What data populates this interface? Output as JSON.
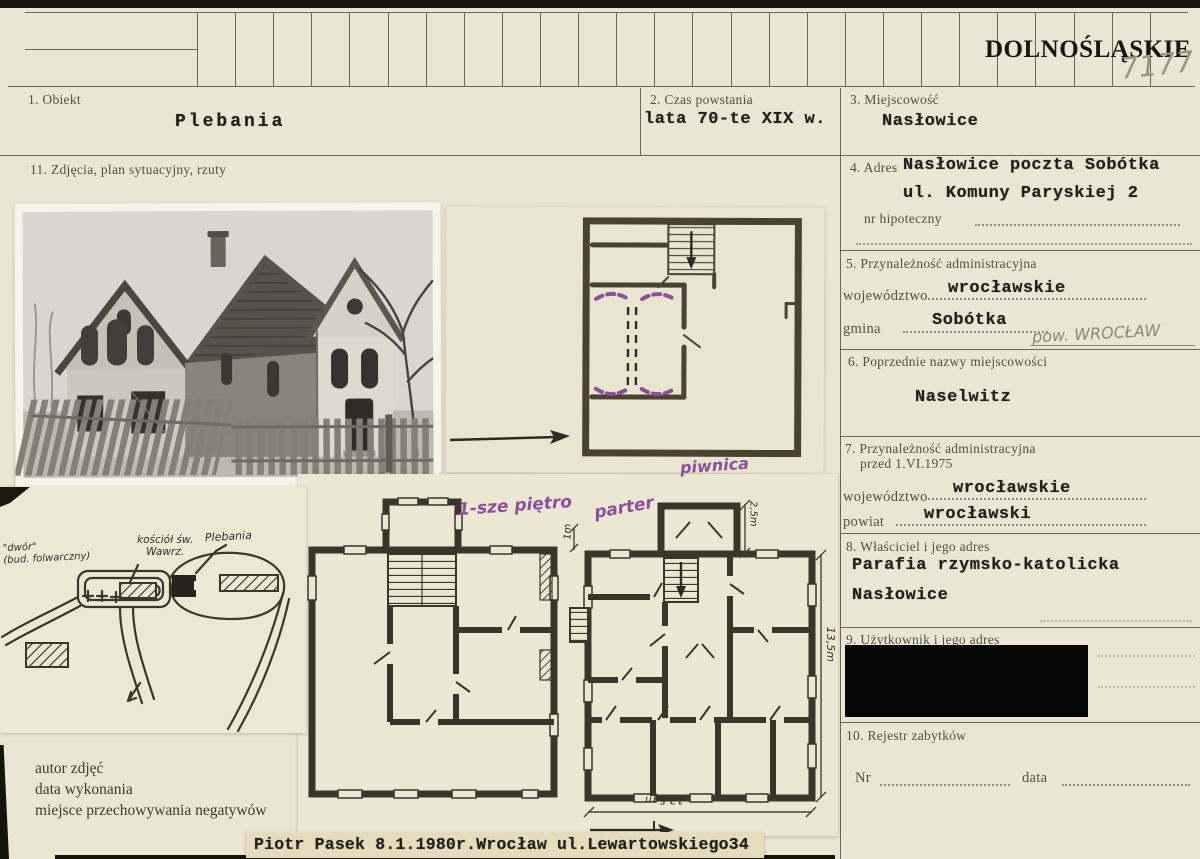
{
  "header": {
    "region": "DOLNOŚLĄSKIE",
    "handwritten_number": "7177"
  },
  "fields": {
    "f1": {
      "label": "1. Obiekt",
      "value": "Plebania"
    },
    "f2": {
      "label": "2. Czas powstania",
      "value": "lata 70-te XIX w."
    },
    "f3": {
      "label": "3. Miejscowość",
      "value": "Nasłowice"
    },
    "f4": {
      "label": "4. Adres",
      "value_line1": "Nasłowice poczta Sobótka",
      "value_line2": "ul. Komuny Paryskiej 2",
      "hypothec_label": "nr hipoteczny"
    },
    "f5": {
      "label": "5. Przynależność administracyjna",
      "wojewodztwo_label": "województwo",
      "wojewodztwo_value": "wrocławskie",
      "gmina_label": "gmina",
      "gmina_value": "Sobótka",
      "pencil_note": "pow. WROCŁAW"
    },
    "f6": {
      "label": "6. Poprzednie nazwy miejscowości",
      "value": "Naselwitz"
    },
    "f7": {
      "label_line1": "7. Przynależność administracyjna",
      "label_line2": "przed 1.VI.1975",
      "wojewodztwo_label": "województwo",
      "wojewodztwo_value": "wrocławskie",
      "powiat_label": "powiat",
      "powiat_value": "wrocławski"
    },
    "f8": {
      "label": "8. Właściciel i jego adres",
      "value_line1": "Parafia rzymsko-katolicka",
      "value_line2": "Nasłowice"
    },
    "f9": {
      "label": "9. Użytkownik i jego adres"
    },
    "f10": {
      "label": "10. Rejestr zabytków",
      "nr_label": "Nr",
      "data_label": "data"
    },
    "f11": {
      "label": "11. Zdjęcia, plan sytuacyjny, rzuty"
    }
  },
  "photo_credit_labels": {
    "line1": "autor zdjęć",
    "line2": "data wykonania",
    "line3": "miejsce przechowywania negatywów"
  },
  "bottom_note": "Piotr Pasek 8.1.1980r.Wrocław ul.Lewartowskiego34",
  "plan_labels": {
    "basement": "piwnica",
    "first_floor": "1-sze piętro",
    "ground_floor": "parter",
    "dim_1m": "1m",
    "dim_2_5m": "2,5m",
    "dim_13_5m_right": "13,5m",
    "dim_13_5m_bottom": "13,5 m"
  },
  "site_plan_labels": {
    "farm_building_line1": "\"dwór\"",
    "farm_building_line2": "(bud. folwarczny)",
    "church_line1": "kościół św.",
    "church_line2": "Wawrz.",
    "rectory": "Plebania"
  },
  "colors": {
    "paper": "#ebe6d3",
    "ink": "#23221e",
    "label_gray": "#55503e",
    "annotation_purple": "#8d4f9b",
    "pencil_gray": "#9b9584",
    "redaction": "#060606",
    "tape": "#e4dcbc"
  }
}
